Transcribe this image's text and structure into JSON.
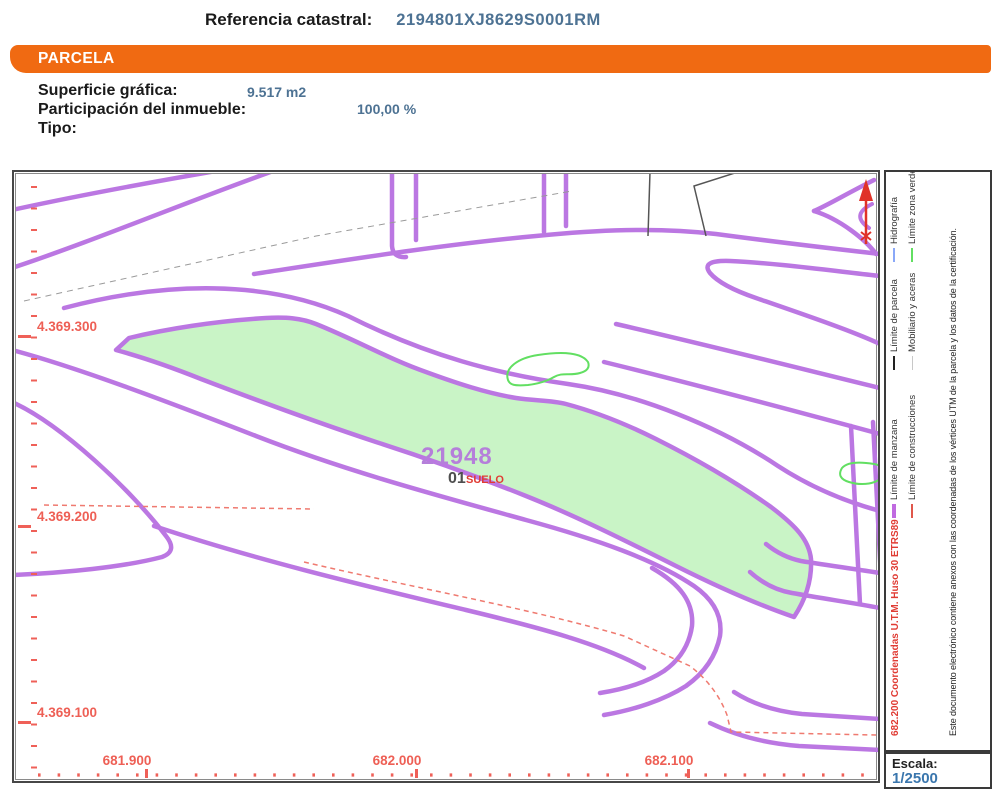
{
  "header": {
    "referencia_label": "Referencia catastral:",
    "referencia_value": "2194801XJ8629S0001RM",
    "section_title": "PARCELA",
    "superficie_label": "Superficie gráfica:",
    "superficie_value": "9.517 m2",
    "participacion_label": "Participación del inmueble:",
    "participacion_value": "100,00 %",
    "tipo_label": "Tipo:"
  },
  "map": {
    "parcel_number": "21948",
    "subparcel_number": "01",
    "land_use": "SUELO",
    "y_axis_labels": [
      "4.369.300",
      "4.369.200",
      "4.369.100"
    ],
    "x_axis_labels": [
      "681.900",
      "682.000",
      "682.100"
    ]
  },
  "legend": {
    "entries": [
      {
        "label": "Límite de manzana",
        "color": "#c06ae0"
      },
      {
        "label": "Límite de parcela",
        "color": "#222222"
      },
      {
        "label": "Hidrografía",
        "color": "#8aa8f8"
      },
      {
        "label": "Límite de construcciones",
        "color": "#e0574b"
      },
      {
        "label": "Mobiliario y aceras",
        "color": "#c8c8c8"
      },
      {
        "label": "Límite zona verde",
        "color": "#62df62"
      }
    ],
    "coordinates_note": "682.200 Coordenadas U.T.M. Huso 30 ETRS89",
    "disclaimer": "Este documento electrónico contiene anexos con las coordenadas de los vértices UTM de la parcela y los datos de la certificación.",
    "scale_label": "Escala:",
    "scale_value": "1/2500"
  },
  "colors": {
    "accent_orange": "#f06a12",
    "value_blue": "#4d7293",
    "road_purple": "#bb77e2",
    "parcel_green_fill": "#c9f4c6",
    "zone_green_line": "#62df62",
    "map_red": "#ee5f55",
    "label_red": "#e03c34",
    "scale_blue": "#3a76ad"
  }
}
